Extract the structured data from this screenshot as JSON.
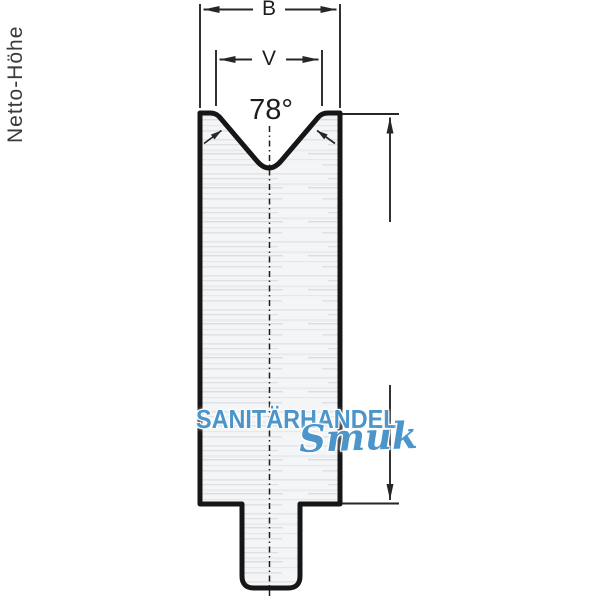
{
  "diagram": {
    "type": "technical-drawing",
    "subject": "v-die-cross-section",
    "dimensions": {
      "width_label": "B",
      "opening_label": "V",
      "angle_label": "78°",
      "height_label": "Netto-Höhe"
    },
    "colors": {
      "outline": "#161616",
      "dimension_lines": "#262626",
      "body_fill": "#f4f5f7",
      "watermark_blue": "#4b95ca"
    }
  },
  "watermark": {
    "line1": "SANITÄRHANDEL",
    "line2": "Smuk"
  }
}
